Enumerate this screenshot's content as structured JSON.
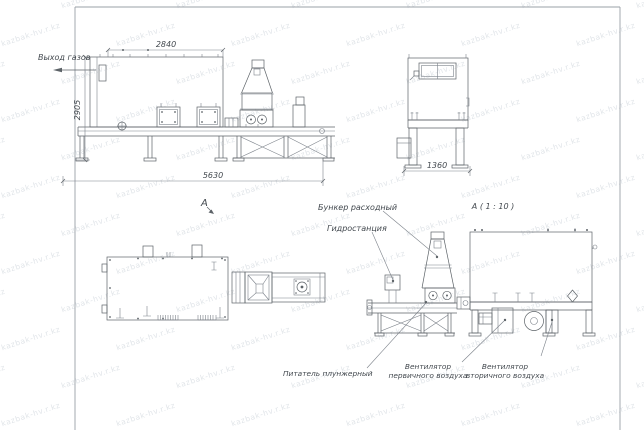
{
  "watermark": {
    "text": "kazbak-hv.r.kz",
    "color": "#e1e5e9"
  },
  "labels": {
    "gas_outlet": "Выход газов",
    "view_arrow": "А",
    "detail_title": "А ( 1 : 10 )",
    "hopper": "Бункер расходный",
    "hydraulic_station": "Гидростанция",
    "feeder": "Питатель плунжерный",
    "fan_primary_line1": "Вентилятор",
    "fan_primary_line2": "первичного воздуха",
    "fan_secondary_line1": "Вентилятор",
    "fan_secondary_line2": "вторичного воздуха"
  },
  "dimensions": {
    "front_top_width": "2840",
    "front_height": "2905",
    "front_total_length": "5630",
    "end_width": "1360"
  },
  "drawing": {
    "line_color": "#5d6368",
    "background": "#ffffff"
  }
}
